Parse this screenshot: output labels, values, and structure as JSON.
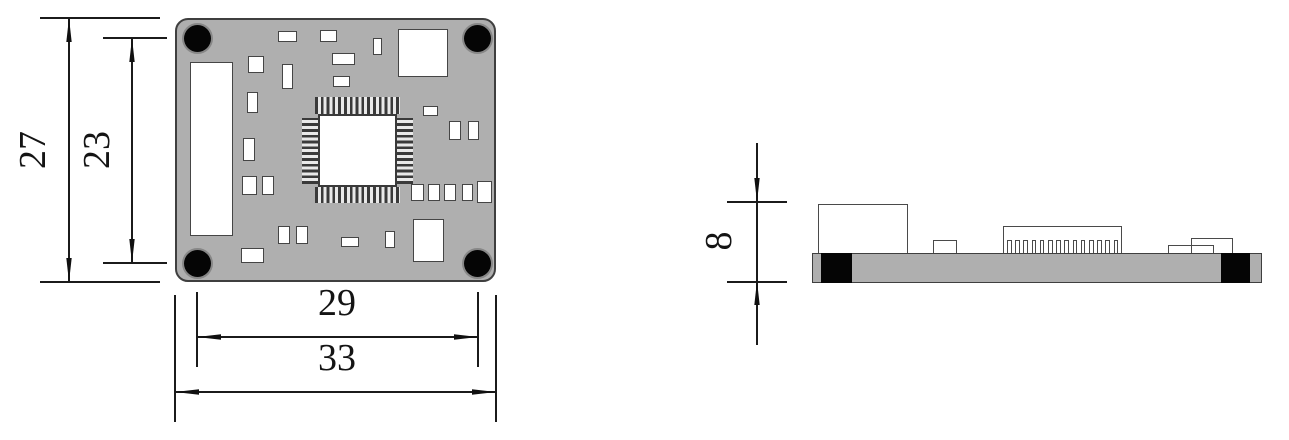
{
  "drawing": {
    "kind": "pcb-mechanical-dimension-drawing",
    "views": [
      "top-view",
      "side-view"
    ]
  },
  "dimensions": {
    "board_overall_height": "27",
    "hole_pitch_vertical": "23",
    "hole_pitch_horizontal": "29",
    "board_overall_width": "33",
    "side_overall_height": "8"
  },
  "colors": {
    "board_fill": "#AFAFAF",
    "outline": "#3F3F3F",
    "hole_fill": "#050505",
    "component_fill": "#FFFFFF",
    "dimension_ink": "#141414",
    "background": "#FFFFFF"
  },
  "geometry": {
    "top_view": {
      "board": [
        175,
        18,
        321,
        264
      ],
      "hole_diameter": 27,
      "holes": [
        [
          197,
          38
        ],
        [
          477,
          38
        ],
        [
          197,
          263
        ],
        [
          477,
          263
        ]
      ],
      "connector": [
        190,
        62,
        43,
        174
      ],
      "qfp_body": [
        318,
        114,
        79,
        73
      ],
      "pads": [
        [
          278,
          31,
          19,
          11
        ],
        [
          320,
          30,
          17,
          12
        ],
        [
          373,
          38,
          9,
          17
        ],
        [
          398,
          29,
          50,
          48
        ],
        [
          248,
          56,
          16,
          17
        ],
        [
          282,
          64,
          11,
          25
        ],
        [
          332,
          53,
          23,
          12
        ],
        [
          333,
          76,
          17,
          11
        ],
        [
          247,
          92,
          11,
          21
        ],
        [
          243,
          138,
          12,
          23
        ],
        [
          242,
          176,
          15,
          19
        ],
        [
          262,
          176,
          12,
          19
        ],
        [
          423,
          106,
          15,
          10
        ],
        [
          449,
          121,
          12,
          19
        ],
        [
          468,
          121,
          11,
          19
        ],
        [
          411,
          184,
          13,
          17
        ],
        [
          428,
          184,
          12,
          17
        ],
        [
          444,
          184,
          12,
          17
        ],
        [
          462,
          184,
          11,
          17
        ],
        [
          477,
          181,
          15,
          22
        ],
        [
          413,
          219,
          31,
          43
        ],
        [
          385,
          231,
          10,
          17
        ],
        [
          341,
          237,
          18,
          10
        ],
        [
          278,
          226,
          12,
          18
        ],
        [
          296,
          226,
          12,
          18
        ],
        [
          241,
          248,
          23,
          15
        ]
      ]
    },
    "side_view": {
      "board": [
        812,
        253,
        450,
        30
      ],
      "end_blocks": [
        [
          821,
          253,
          31,
          30
        ],
        [
          1221,
          253,
          29,
          30
        ]
      ],
      "header_pin_count": 14,
      "header_pin_pitch": 8.2
    }
  }
}
